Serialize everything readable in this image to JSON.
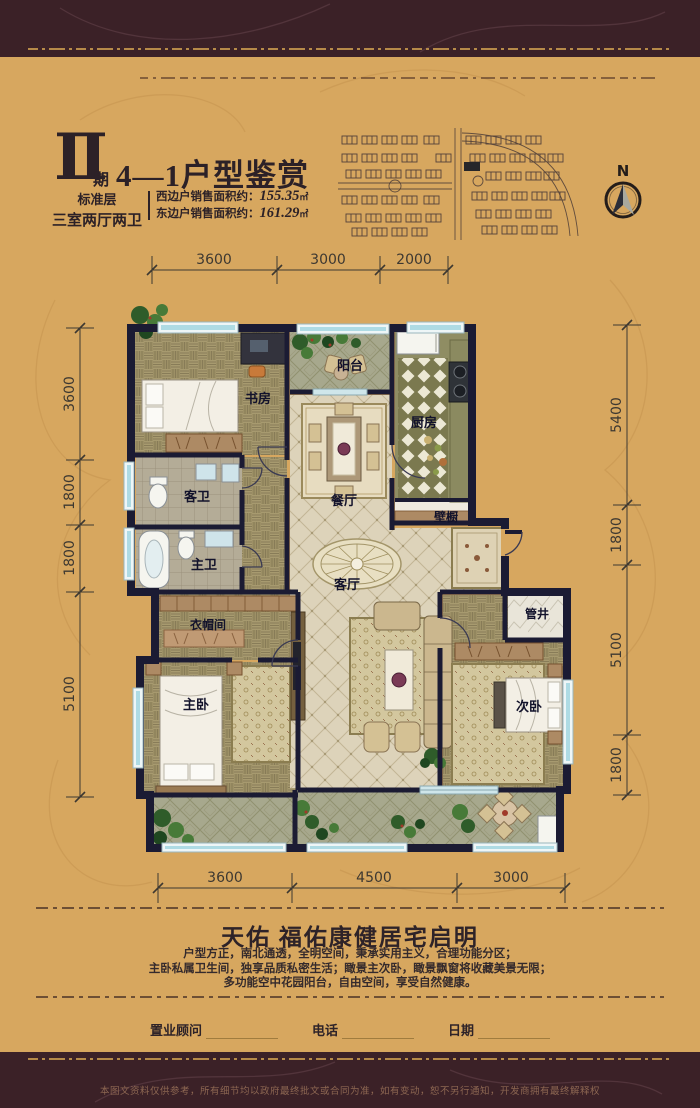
{
  "header": {
    "phase_numeral": "Ⅱ",
    "phase_suffix": "期",
    "title": "4—1户型鉴赏",
    "floor_type": "标准层",
    "layout_type": "三室两厅两卫",
    "area_west_label": "西边户销售面积约：",
    "area_west_value": "155.35",
    "area_west_unit": "㎡",
    "area_east_label": "东边户销售面积约：",
    "area_east_value": "161.29",
    "area_east_unit": "㎡"
  },
  "compass": {
    "north_label": "N"
  },
  "floorplan": {
    "rooms": {
      "study": "书房",
      "balcony_top": "阳台",
      "kitchen": "厨房",
      "dining": "餐厅",
      "guest_bath": "客卫",
      "master_bath": "主卫",
      "closet": "壁橱",
      "living": "客厅",
      "cloakroom": "衣帽间",
      "master_bedroom": "主卧",
      "second_bedroom": "次卧",
      "pipe_shaft": "管井"
    },
    "dimensions": {
      "top": [
        "3600",
        "3000",
        "2000"
      ],
      "left": [
        "3600",
        "1800",
        "1800",
        "5100"
      ],
      "right": [
        "5400",
        "1800",
        "5100",
        "1800"
      ],
      "bottom": [
        "3600",
        "4500",
        "3000"
      ]
    }
  },
  "footer": {
    "slogan": "天佑  福佑康健居宅启明",
    "description_lines": [
      "户型方正，南北通透，全明空间，秉承实用主义，合理功能分区；",
      "主卧私属卫生间，独享品质私密生活；瞰景主次卧，瞰景飘窗将收藏美景无限；",
      "多功能空中花园阳台，自由空间，享受自然健康。"
    ],
    "signature_fields": [
      {
        "label": "置业顾问"
      },
      {
        "label": "电话"
      },
      {
        "label": "日期"
      }
    ],
    "disclaimer": "本图文资料仅供参考，所有细节均以政府最终批文或合同为准，如有变动，恕不另行通知，开发商拥有最终解释权"
  },
  "colors": {
    "background_gold": "#d7a75f",
    "band_maroon": "#3b2127",
    "wall_navy": "#1b1b33",
    "window_blue": "#aedbe4",
    "ornament_gold": "#b68a49"
  }
}
